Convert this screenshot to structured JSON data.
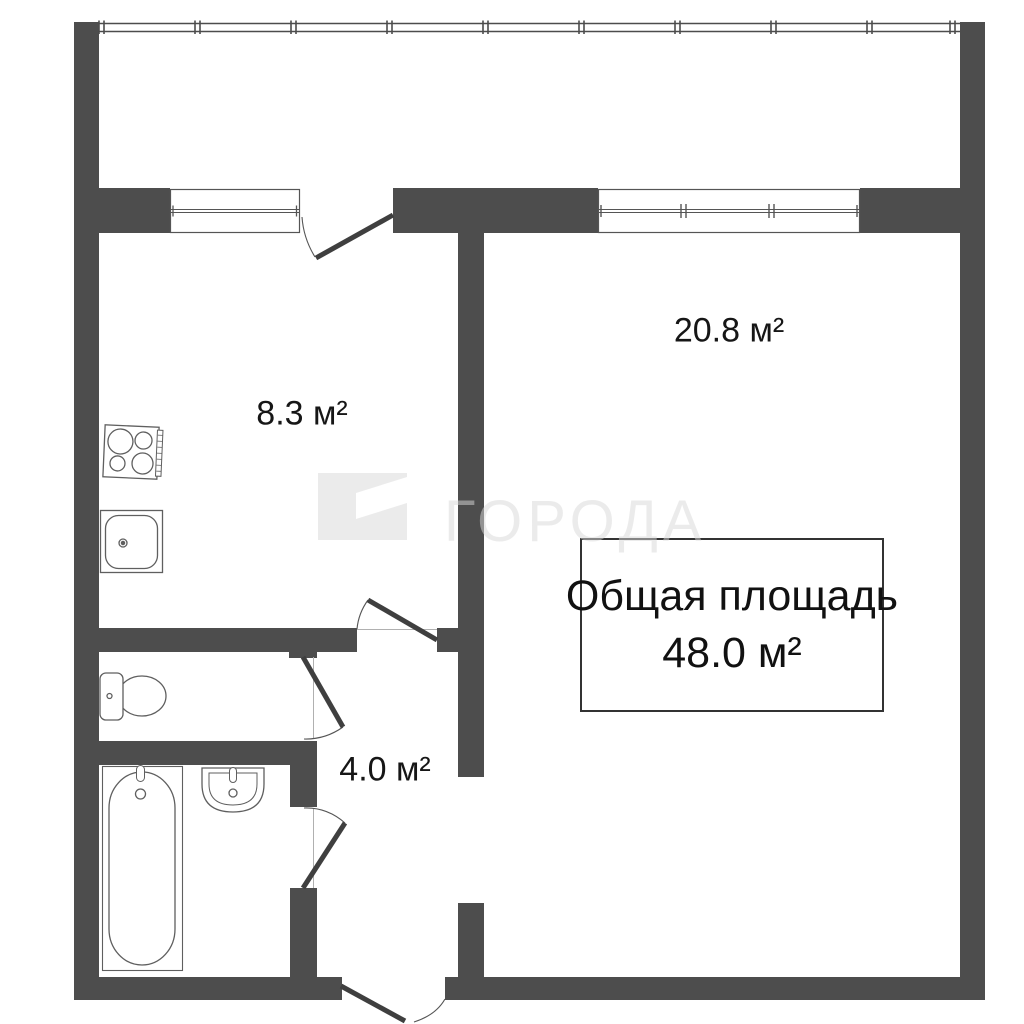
{
  "plan": {
    "rooms": [
      {
        "name": "kitchen",
        "area_label": "8.3 м²"
      },
      {
        "name": "living-room",
        "area_label": "20.8 м²"
      },
      {
        "name": "hallway",
        "area_label": "4.0 м²"
      }
    ],
    "total_area": {
      "title": "Общая площадь",
      "value": "48.0 м²"
    },
    "watermark": {
      "text": "ГОРОДА"
    },
    "colors": {
      "wall": "#4d4d4d",
      "fixture_stroke": "#5f5f5f",
      "label_text": "#161616",
      "watermark": "#d9d9d9"
    }
  }
}
